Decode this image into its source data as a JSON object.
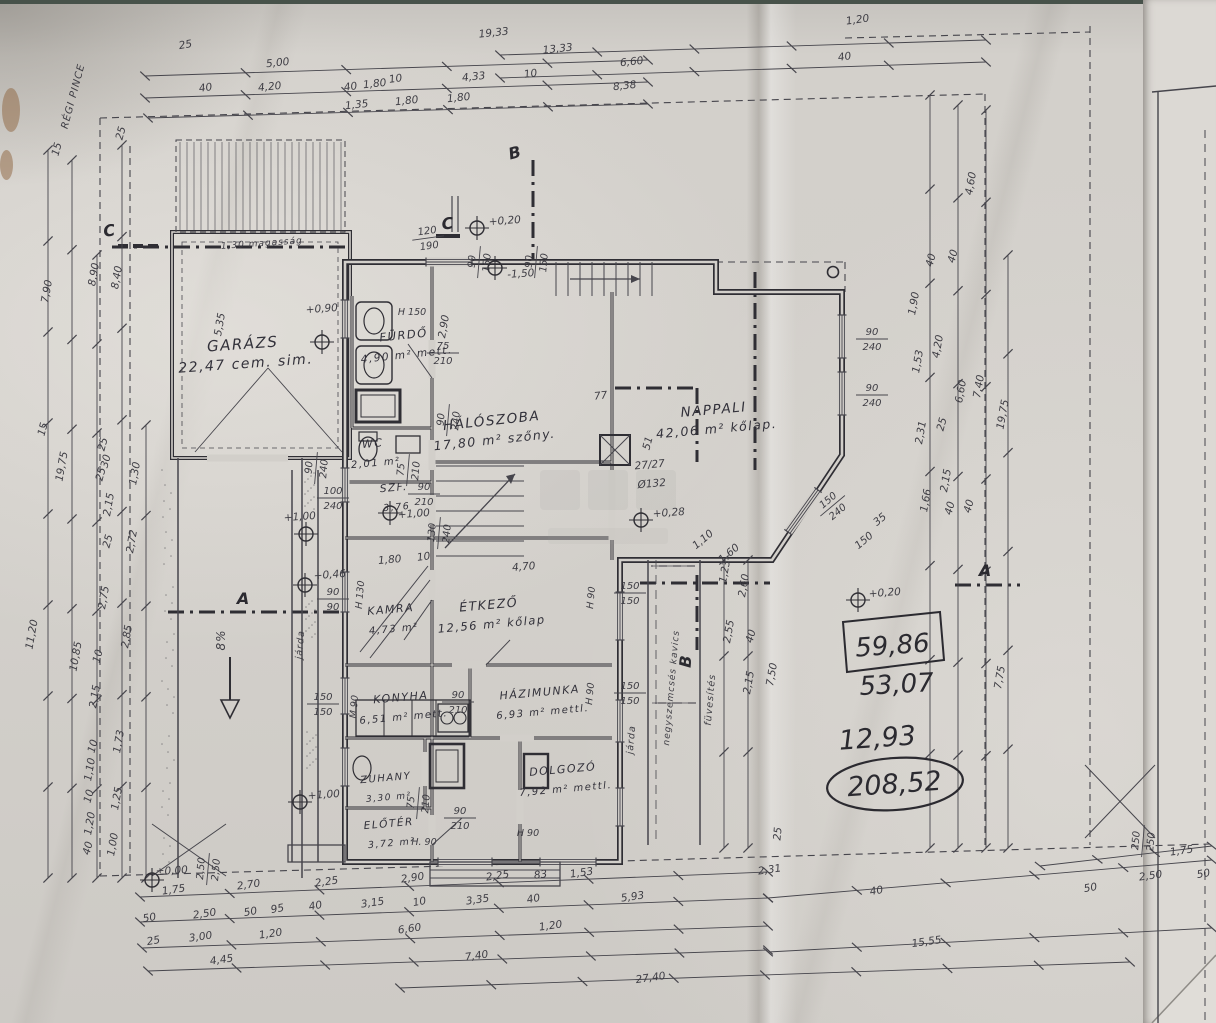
{
  "drawing": {
    "type": "hand-drawn house floor plan (Hungarian)",
    "rooms": [
      {
        "name": "GARÁZS",
        "area": "22,47",
        "finish": "cem. sim.",
        "x": 243,
        "y": 349,
        "fs": 15,
        "r": -4
      },
      {
        "name": "FÜRDŐ",
        "area": "4,90 m²",
        "finish": "mett.",
        "x": 404,
        "y": 339,
        "fs": 11.5,
        "r": -6
      },
      {
        "name": "WC",
        "area": "2,01 m²",
        "finish": "",
        "x": 373,
        "y": 447,
        "fs": 11,
        "r": -5
      },
      {
        "name": "SZF.",
        "area": "3,76",
        "finish": "",
        "x": 394,
        "y": 491,
        "fs": 10.5,
        "r": -5
      },
      {
        "name": "HÁLÓSZOBA",
        "area": "17,80 m²",
        "finish": "szőny.",
        "x": 492,
        "y": 425,
        "fs": 13.5,
        "r": -6
      },
      {
        "name": "NAPPALI",
        "area": "42,06 m²",
        "finish": "kőlap.",
        "x": 714,
        "y": 414,
        "fs": 13.5,
        "r": -5
      },
      {
        "name": "KAMRA",
        "area": "4,73 m²",
        "finish": "",
        "x": 391,
        "y": 613,
        "fs": 11,
        "r": -5
      },
      {
        "name": "ÉTKEZŐ",
        "area": "12,56 m²",
        "finish": "kőlap",
        "x": 489,
        "y": 609,
        "fs": 12.5,
        "r": -5
      },
      {
        "name": "KONYHA",
        "area": "6,51 m²",
        "finish": "mett.",
        "x": 401,
        "y": 701,
        "fs": 11,
        "r": -5
      },
      {
        "name": "HÁZIMUNKA",
        "area": "6,93 m²",
        "finish": "mettl.",
        "x": 540,
        "y": 696,
        "fs": 11,
        "r": -5
      },
      {
        "name": "ZUHANY",
        "area": "3,30 m²",
        "finish": "",
        "x": 386,
        "y": 781,
        "fs": 10,
        "r": -5
      },
      {
        "name": "ELŐTÉR",
        "area": "3,72 m²",
        "finish": "",
        "x": 389,
        "y": 827,
        "fs": 10.5,
        "r": -5
      },
      {
        "name": "DOLGOZÓ",
        "area": "7,92 m²",
        "finish": "mettl.",
        "x": 563,
        "y": 773,
        "fs": 11,
        "r": -5
      }
    ],
    "handwritten": {
      "boxed": "59,86",
      "sum_a": "53,07",
      "sum_b": "12,93",
      "total_circled": "208,52"
    },
    "levels": [
      {
        "t": "±0,00",
        "cx": 152,
        "cy": 880,
        "tx": 172,
        "ty": 874
      },
      {
        "t": "+0,20",
        "cx": 477,
        "cy": 228,
        "tx": 505,
        "ty": 224
      },
      {
        "t": "+0,20",
        "cx": 858,
        "cy": 600,
        "tx": 885,
        "ty": 596
      },
      {
        "t": "+0,28",
        "cx": 641,
        "cy": 520,
        "tx": 669,
        "ty": 516
      },
      {
        "t": "+0,46",
        "cx": 305,
        "cy": 585,
        "tx": 330,
        "ty": 578
      },
      {
        "t": "+0,90",
        "cx": 322,
        "cy": 342,
        "tx": 322,
        "ty": 312
      },
      {
        "t": "+1,00",
        "cx": 306,
        "cy": 534,
        "tx": 300,
        "ty": 520
      },
      {
        "t": "+1,00",
        "cx": 390,
        "cy": 513,
        "tx": 414,
        "ty": 517
      },
      {
        "t": "+1,00",
        "cx": 300,
        "cy": 802,
        "tx": 324,
        "ty": 798
      },
      {
        "t": "-1,50",
        "cx": 495,
        "cy": 268,
        "tx": 521,
        "ty": 277
      }
    ],
    "section_markers": [
      {
        "t": "A",
        "x": 243,
        "y": 604,
        "r": 0
      },
      {
        "t": "A",
        "x": 985,
        "y": 576,
        "r": 0
      },
      {
        "t": "B",
        "x": 516,
        "y": 158,
        "r": -15
      },
      {
        "t": "B",
        "x": 691,
        "y": 662,
        "r": -85
      },
      {
        "t": "C",
        "x": 110,
        "y": 236,
        "r": -8
      },
      {
        "t": "C",
        "x": 448,
        "y": 229,
        "r": -5
      }
    ],
    "notes": [
      {
        "t": "RÉGI PINCE",
        "x": 76,
        "y": 97,
        "r": -75,
        "fs": 10
      },
      {
        "t": "1,30 magasság",
        "x": 262,
        "y": 246,
        "r": -4,
        "fs": 9
      },
      {
        "t": "járda",
        "x": 303,
        "y": 645,
        "r": -85,
        "fs": 9.5
      },
      {
        "t": "járda",
        "x": 634,
        "y": 740,
        "r": -85,
        "fs": 9.5
      },
      {
        "t": "negyszemcsés kavics",
        "x": 674,
        "y": 688,
        "r": -85,
        "fs": 9
      },
      {
        "t": "füvesítés",
        "x": 713,
        "y": 700,
        "r": -85,
        "fs": 9.5
      },
      {
        "t": "8%",
        "x": 225,
        "y": 640,
        "r": -90,
        "fs": 12
      }
    ],
    "height_marks": [
      {
        "t": "H 150",
        "x": 412,
        "y": 315,
        "r": 0
      },
      {
        "t": "H 130",
        "x": 363,
        "y": 595,
        "r": -85
      },
      {
        "t": "M 90",
        "x": 357,
        "y": 707,
        "r": -85
      },
      {
        "t": "H 90",
        "x": 594,
        "y": 598,
        "r": -85
      },
      {
        "t": "H 90",
        "x": 593,
        "y": 694,
        "r": -85
      },
      {
        "t": "H 90",
        "x": 528,
        "y": 836,
        "r": 0
      },
      {
        "t": "H. 90",
        "x": 424,
        "y": 845,
        "r": 0
      }
    ],
    "fractions": [
      [
        "75",
        "210",
        443,
        352,
        0
      ],
      [
        "75",
        "210",
        407,
        470,
        -85
      ],
      [
        "100",
        "240",
        333,
        497,
        0
      ],
      [
        "90",
        "210",
        424,
        493,
        0
      ],
      [
        "90",
        "240",
        315,
        468,
        -85
      ],
      [
        "90",
        "240",
        447,
        420,
        -85
      ],
      [
        "130",
        "240",
        438,
        533,
        -85
      ],
      [
        "90",
        "210",
        458,
        701,
        0
      ],
      [
        "90",
        "210",
        460,
        817,
        0
      ],
      [
        "75",
        "210",
        417,
        803,
        -85
      ],
      [
        "120",
        "190",
        428,
        237,
        -8
      ],
      [
        "90",
        "150",
        478,
        262,
        -85
      ],
      [
        "90",
        "150",
        535,
        262,
        -85
      ],
      [
        "90",
        "240",
        872,
        338,
        0
      ],
      [
        "90",
        "240",
        872,
        394,
        0
      ],
      [
        "150",
        "150",
        630,
        592,
        0
      ],
      [
        "150",
        "150",
        630,
        692,
        0
      ],
      [
        "2,50",
        "2,50",
        207,
        869,
        -85
      ],
      [
        "250",
        "250",
        1142,
        841,
        -85
      ],
      [
        "150",
        "240",
        832,
        505,
        -40
      ],
      [
        "90",
        "90",
        333,
        598,
        0
      ],
      [
        "150",
        "150",
        323,
        703,
        0
      ]
    ],
    "dim_labels": [
      [
        "25",
        186,
        48,
        -10
      ],
      [
        "5,00",
        278,
        66,
        -6
      ],
      [
        "4,20",
        270,
        90,
        -6
      ],
      [
        "40",
        206,
        91,
        -8
      ],
      [
        "40",
        351,
        90,
        -8
      ],
      [
        "1,35",
        357,
        108,
        -6
      ],
      [
        "1,80",
        375,
        87,
        -6
      ],
      [
        "10",
        396,
        82,
        -8
      ],
      [
        "1,80",
        407,
        104,
        -6
      ],
      [
        "1,80",
        459,
        101,
        -6
      ],
      [
        "4,33",
        474,
        80,
        -6
      ],
      [
        "10",
        531,
        77,
        -8
      ],
      [
        "19,33",
        494,
        36,
        -6
      ],
      [
        "13,33",
        558,
        52,
        -6
      ],
      [
        "6,60",
        632,
        65,
        -6
      ],
      [
        "8,38",
        625,
        89,
        -6
      ],
      [
        "1,20",
        858,
        23,
        -8
      ],
      [
        "40",
        845,
        60,
        -8
      ],
      [
        "4,60",
        974,
        184,
        -80
      ],
      [
        "40",
        934,
        261,
        -75
      ],
      [
        "40",
        956,
        257,
        -75
      ],
      [
        "1,90",
        917,
        304,
        -80
      ],
      [
        "1,53",
        921,
        362,
        -80
      ],
      [
        "4,20",
        941,
        347,
        -80
      ],
      [
        "2,31",
        924,
        433,
        -80
      ],
      [
        "25",
        945,
        425,
        -75
      ],
      [
        "6,60",
        964,
        392,
        -80
      ],
      [
        "7,40",
        982,
        387,
        -80
      ],
      [
        "2,15",
        949,
        481,
        -80
      ],
      [
        "1,66",
        929,
        501,
        -80
      ],
      [
        "40",
        953,
        509,
        -75
      ],
      [
        "40",
        972,
        507,
        -75
      ],
      [
        "19,75",
        1006,
        415,
        -80
      ],
      [
        "7,75",
        1003,
        678,
        -80
      ],
      [
        "1,23",
        728,
        572,
        -80
      ],
      [
        "2,60",
        747,
        586,
        -80
      ],
      [
        "2,55",
        732,
        632,
        -80
      ],
      [
        "40",
        754,
        637,
        -75
      ],
      [
        "7,50",
        775,
        675,
        -80
      ],
      [
        "2,15",
        752,
        683,
        -80
      ],
      [
        "1,10",
        705,
        542,
        -40
      ],
      [
        "1,60",
        731,
        556,
        -40
      ],
      [
        "35",
        882,
        522,
        -40
      ],
      [
        "150",
        866,
        543,
        -40
      ],
      [
        "15",
        60,
        150,
        -75
      ],
      [
        "25",
        124,
        134,
        -75
      ],
      [
        "7,90",
        50,
        292,
        -80
      ],
      [
        "8,90",
        97,
        275,
        -80
      ],
      [
        "8,40",
        120,
        278,
        -80
      ],
      [
        "15",
        46,
        430,
        -75
      ],
      [
        "19,75",
        65,
        467,
        -80
      ],
      [
        "11,20",
        35,
        635,
        -80
      ],
      [
        "10,85",
        79,
        657,
        -80
      ],
      [
        "25",
        106,
        445,
        -75
      ],
      [
        "30",
        109,
        462,
        -75
      ],
      [
        "25",
        104,
        475,
        -75
      ],
      [
        "2,15",
        112,
        505,
        -80
      ],
      [
        "1,30",
        138,
        474,
        -80
      ],
      [
        "25",
        111,
        542,
        -75
      ],
      [
        "2,72",
        135,
        542,
        -80
      ],
      [
        "2,75",
        107,
        598,
        -80
      ],
      [
        "2,85",
        130,
        637,
        -80
      ],
      [
        "10",
        101,
        657,
        -75
      ],
      [
        "2,15",
        98,
        697,
        -80
      ],
      [
        "10",
        96,
        747,
        -75
      ],
      [
        "1,10",
        93,
        770,
        -80
      ],
      [
        "10",
        92,
        797,
        -75
      ],
      [
        "1,73",
        122,
        742,
        -80
      ],
      [
        "1,25",
        120,
        799,
        -80
      ],
      [
        "1,20",
        93,
        824,
        -80
      ],
      [
        "40",
        91,
        849,
        -75
      ],
      [
        "1,00",
        116,
        845,
        -80
      ],
      [
        "1,80",
        390,
        563,
        -5
      ],
      [
        "10",
        424,
        560,
        -7
      ],
      [
        "4,70",
        524,
        570,
        -5
      ],
      [
        "77",
        601,
        399,
        -6
      ],
      [
        "5,35",
        223,
        325,
        -80
      ],
      [
        "2,90",
        447,
        327,
        -80
      ],
      [
        "51",
        651,
        444,
        -75
      ],
      [
        "27/27",
        650,
        468,
        -5
      ],
      [
        "Ø132",
        652,
        487,
        -5
      ],
      [
        "1,75",
        174,
        893,
        -8
      ],
      [
        "2,70",
        249,
        888,
        -8
      ],
      [
        "2,25",
        327,
        885,
        -8
      ],
      [
        "2,90",
        413,
        881,
        -8
      ],
      [
        "2,25",
        498,
        879,
        -8
      ],
      [
        "83",
        541,
        878,
        -8
      ],
      [
        "1,53",
        582,
        876,
        -8
      ],
      [
        "2,31",
        770,
        873,
        -8
      ],
      [
        "50",
        150,
        921,
        -10
      ],
      [
        "2,50",
        205,
        917,
        -8
      ],
      [
        "50",
        251,
        915,
        -10
      ],
      [
        "95",
        278,
        912,
        -10
      ],
      [
        "40",
        316,
        909,
        -10
      ],
      [
        "3,15",
        373,
        906,
        -8
      ],
      [
        "10",
        420,
        905,
        -10
      ],
      [
        "3,35",
        478,
        903,
        -8
      ],
      [
        "40",
        534,
        902,
        -10
      ],
      [
        "5,93",
        633,
        900,
        -8
      ],
      [
        "25",
        154,
        944,
        -10
      ],
      [
        "3,00",
        201,
        940,
        -8
      ],
      [
        "1,20",
        271,
        937,
        -8
      ],
      [
        "6,60",
        410,
        932,
        -8
      ],
      [
        "1,20",
        551,
        929,
        -8
      ],
      [
        "4,45",
        222,
        963,
        -8
      ],
      [
        "7,40",
        477,
        959,
        -8
      ],
      [
        "27,40",
        651,
        981,
        -8
      ],
      [
        "40",
        877,
        894,
        -10
      ],
      [
        "15,55",
        927,
        945,
        -8
      ],
      [
        "50",
        1091,
        891,
        -10
      ],
      [
        "2,50",
        1151,
        879,
        -8
      ],
      [
        "50",
        1204,
        877,
        -10
      ],
      [
        "1,75",
        1182,
        854,
        -8
      ],
      [
        "25",
        781,
        834,
        -85
      ]
    ]
  }
}
